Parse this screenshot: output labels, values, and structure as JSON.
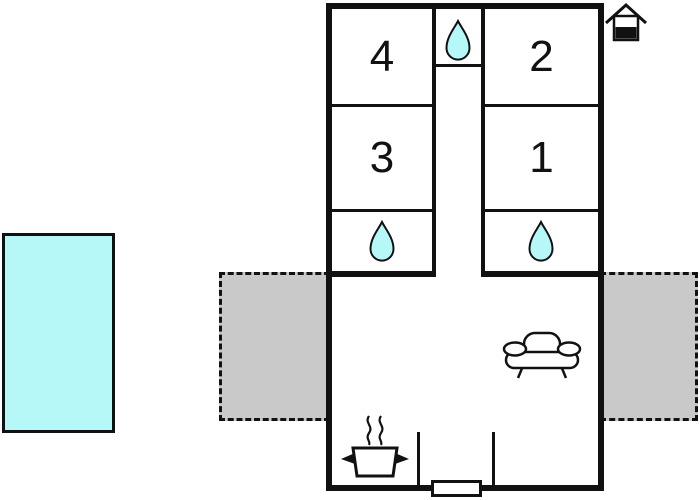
{
  "document": {
    "kind": "floor-plan",
    "description": "holiday-home floor plan with four numbered rooms, corridor, two bathrooms, living room, pool and two terraces"
  },
  "colors": {
    "wall": "#111111",
    "water": "#b6f7f7",
    "terrace": "#c9c9c9",
    "background": "#ffffff"
  },
  "rooms": [
    {
      "number": "4"
    },
    {
      "number": "2"
    },
    {
      "number": "3"
    },
    {
      "number": "1"
    }
  ],
  "icons": {
    "water_drop": "water-drop-icon",
    "sofa": "sofa-icon",
    "stove": "stove-icon",
    "house_orientation": "house-north-icon",
    "pool": "swimming-pool",
    "terrace_left": "terrace-left",
    "terrace_right": "terrace-right",
    "door": "entrance-door"
  }
}
